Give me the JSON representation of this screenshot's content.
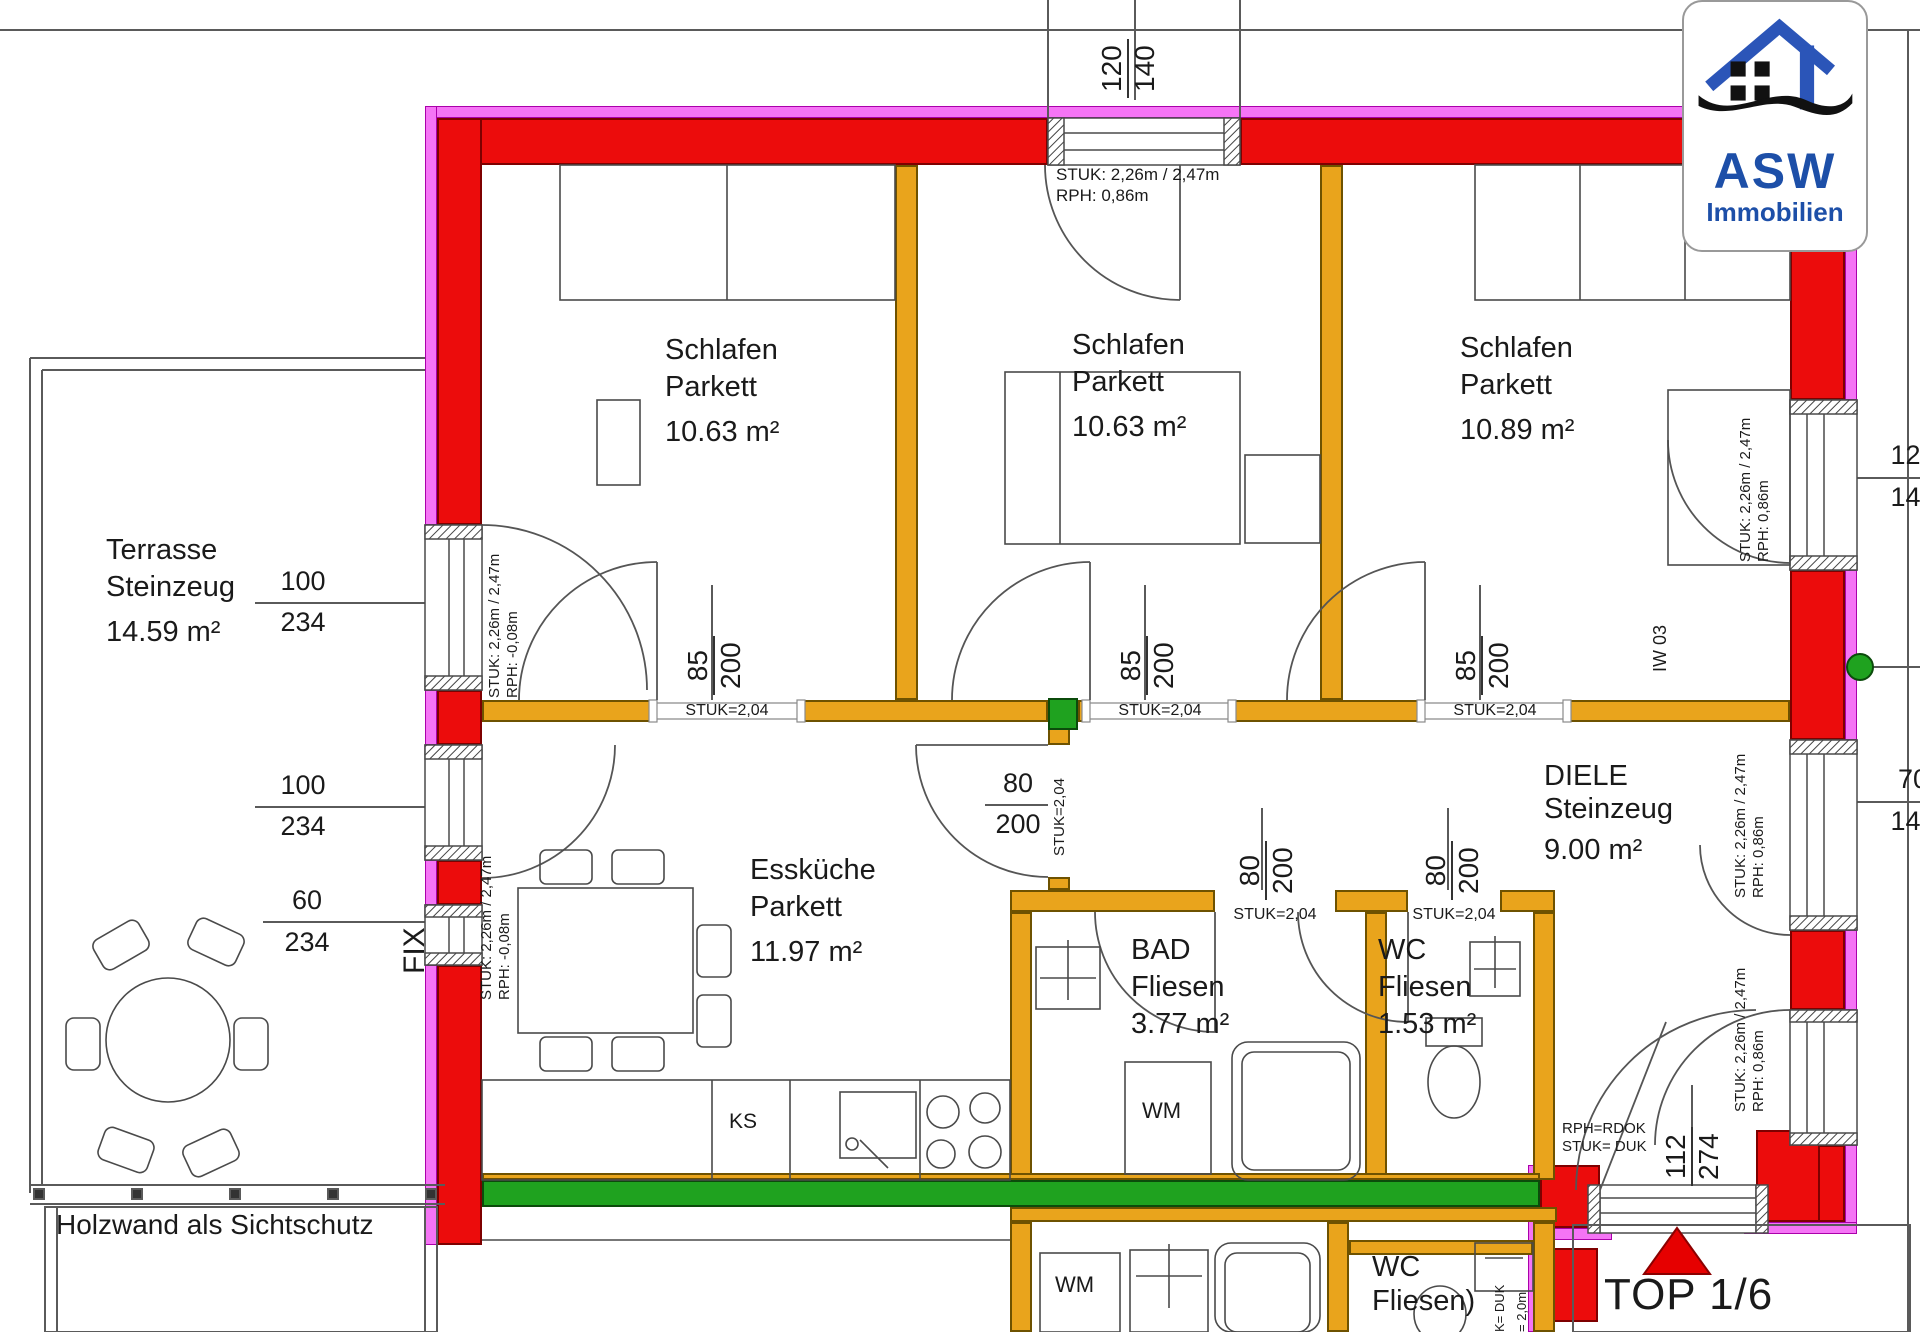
{
  "logo": {
    "brand": "ASW",
    "subtitle": "Immobilien"
  },
  "unit": {
    "label": "TOP 1/6"
  },
  "rooms": {
    "schlafen1": {
      "name": "Schlafen",
      "floor": "Parkett",
      "area": "10.63 m²"
    },
    "schlafen2": {
      "name": "Schlafen",
      "floor": "Parkett",
      "area": "10.63 m²"
    },
    "schlafen3": {
      "name": "Schlafen",
      "floor": "Parkett",
      "area": "10.89 m²"
    },
    "terrasse": {
      "name": "Terrasse",
      "floor": "Steinzeug",
      "area": "14.59 m²"
    },
    "esskueche": {
      "name": "Essküche",
      "floor": "Parkett",
      "area": "11.97 m²"
    },
    "bad": {
      "name": "BAD",
      "floor": "Fliesen",
      "area": "3.77 m²"
    },
    "wc": {
      "name": "WC",
      "floor": "Fliesen",
      "area": "1.53 m²"
    },
    "diele": {
      "name": "DIELE",
      "floor": "Steinzeug",
      "area": "9.00 m²"
    },
    "wc_lower": {
      "name": "WC",
      "floor": "Fliesen)"
    }
  },
  "dims": {
    "top_window": {
      "num": "120",
      "den": "140"
    },
    "terrace_door_1": {
      "num": "100",
      "den": "234"
    },
    "terrace_door_2": {
      "num": "100",
      "den": "234"
    },
    "fix_window": {
      "num": "60",
      "den": "234"
    },
    "door_s1": {
      "num": "85",
      "den": "200"
    },
    "door_s2": {
      "num": "85",
      "den": "200"
    },
    "door_s3": {
      "num": "85",
      "den": "200"
    },
    "door_kitchen": {
      "num": "80",
      "den": "200"
    },
    "door_bad": {
      "num": "80",
      "den": "200"
    },
    "door_wc": {
      "num": "80",
      "den": "200"
    },
    "entry_door": {
      "num": "112",
      "den": "274"
    },
    "right_window_top": {
      "num": "120",
      "den": "140"
    },
    "right_window_mid": {
      "num": "70",
      "den": "140"
    }
  },
  "annotations": {
    "stuk_std": "STUK: 2,26m / 2,47m",
    "rph_086": "RPH: 0,86m",
    "rph_n008": "RPH: -0,08m",
    "stuk_lintel": "STUK=2,04",
    "entry_rph": "RPH=RDOK",
    "entry_stuk": "STUK= DUK",
    "iw03": "IW 03",
    "fix": "FIX",
    "ks": "KS",
    "wm": "WM",
    "holzwand": "Holzwand als Sichtschutz",
    "k_duk": "K= DUK",
    "m_20": "= 2,0m"
  }
}
